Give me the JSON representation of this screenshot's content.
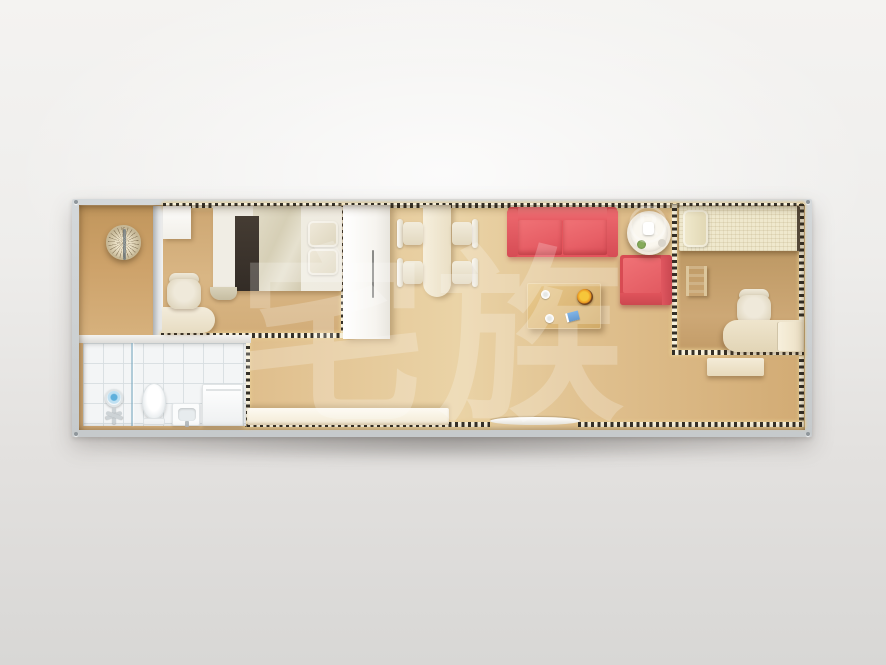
{
  "image": {
    "kind": "top-down 3D floor-plan rendering",
    "subject": "single-module container home interior"
  },
  "watermark": {
    "text": "宅族",
    "registered": "®"
  },
  "palette": {
    "backdrop": "#edecea",
    "container_frame": "#ccd0d2",
    "dash_dark": "#343028",
    "dash_light": "#f7f0da",
    "dash_glow": "#e8cc92",
    "wood_entry": "#c9a069",
    "wood_bedroom1": "#d6b080",
    "wood_living": "#e4c795",
    "wood_bedroom2": "#bf9a66",
    "wall_white": "#f2f1ee",
    "bath_tile": "#f4f6f7",
    "sofa_red": "#e8575e",
    "armchair_red": "#e25b60",
    "bed1_duvet": "#dcd5bf",
    "bed1_runner": "#3b342d",
    "bed2_cream": "#f0e9cd",
    "counter_cream": "#f7f1e2",
    "coffee_table_wood": "#ddb97a"
  },
  "labels": {
    "hanging_chair": "hanging rattan chair",
    "bedside_cabinet": "bedside cabinet",
    "double_bed": "double bed",
    "desk": "desk",
    "desk_chair": "desk chair",
    "wardrobe": "wardrobe",
    "shower": "shower fixture",
    "glass_partition": "shower glass partition",
    "toilet": "toilet",
    "sink": "wash basin",
    "washer": "washing machine",
    "kitchen_counter": "kitchen counter",
    "door_sill": "entrance door sill",
    "dining_table": "dining table",
    "dining_chair": "dining chair",
    "sofa": "red two-seat sofa",
    "armchair": "red armchair",
    "side_table": "round side table",
    "coffee_table": "coffee table",
    "fruit_bowl": "fruit bowl",
    "single_bed": "single bed",
    "ladder": "bed ladder",
    "office_chair": "office chair",
    "console_table": "console table"
  },
  "rooms": [
    {
      "name": "entry-closet",
      "furniture": [
        "hanging rattan chair"
      ]
    },
    {
      "name": "master-bedroom",
      "furniture": [
        "double bed",
        "bedside cabinet",
        "desk",
        "desk chair",
        "wardrobe"
      ]
    },
    {
      "name": "bathroom",
      "furniture": [
        "shower fixture",
        "glass partition",
        "toilet",
        "wash basin",
        "washing machine"
      ]
    },
    {
      "name": "kitchen",
      "furniture": [
        "kitchen counter"
      ]
    },
    {
      "name": "living-dining",
      "furniture": [
        "dining table",
        "4 dining chairs",
        "red two-seat sofa",
        "red armchair",
        "round side table",
        "coffee table",
        "fruit bowl",
        "door sill"
      ]
    },
    {
      "name": "second-bedroom",
      "furniture": [
        "single bed",
        "bed ladder",
        "desk",
        "office chair",
        "console table"
      ]
    }
  ]
}
